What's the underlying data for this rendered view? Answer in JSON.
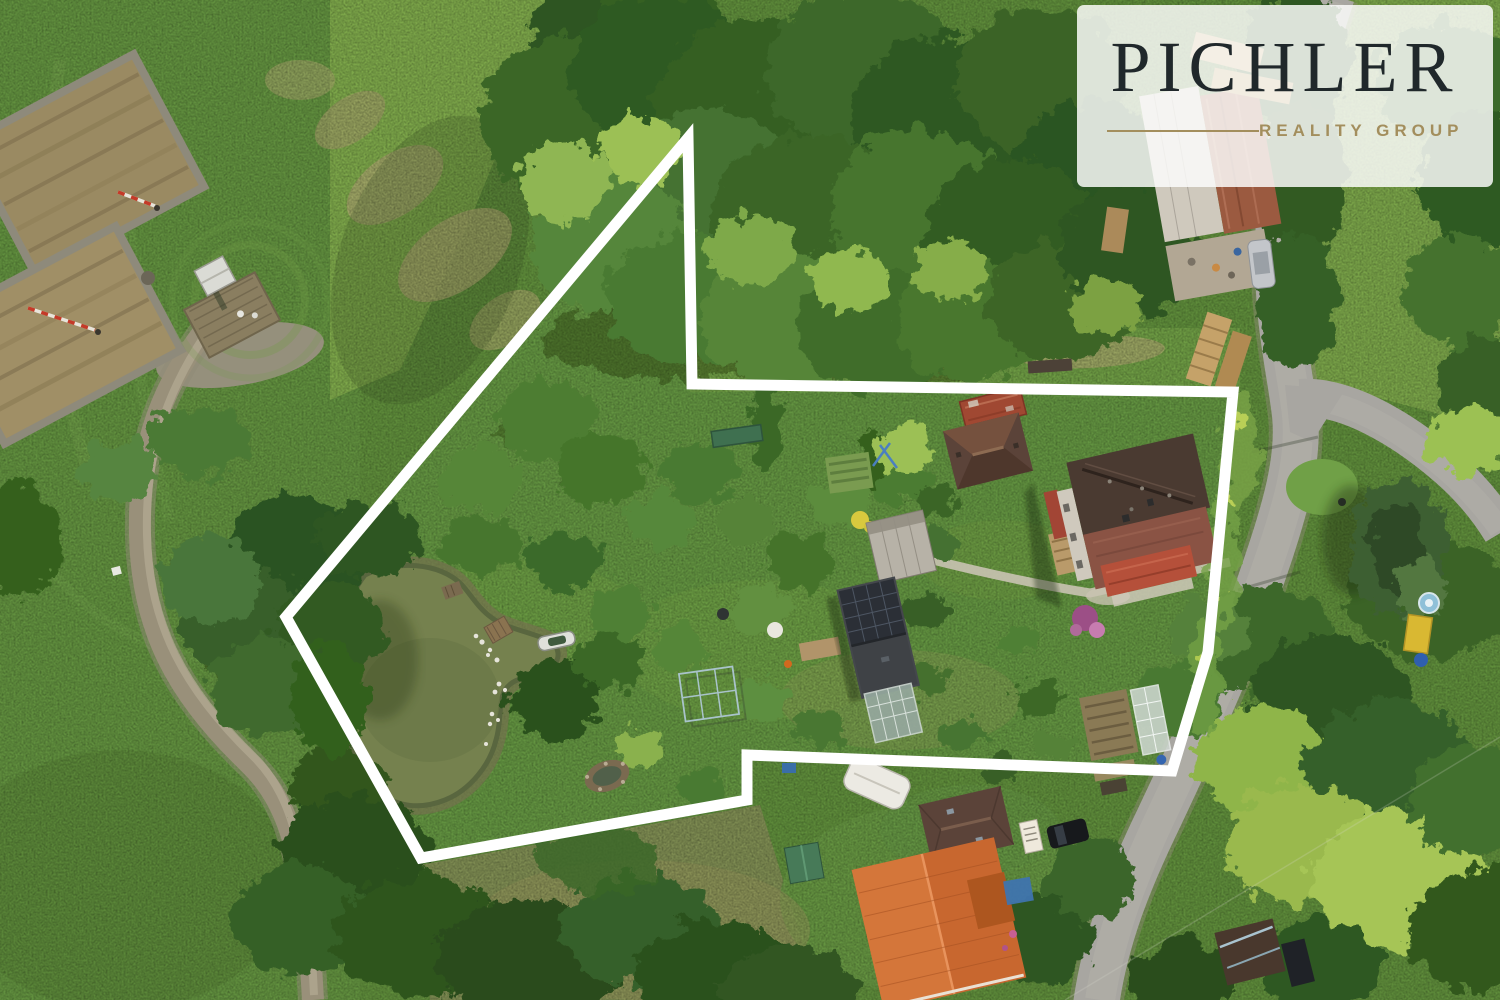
{
  "image_type": "aerial-drone-photograph-with-property-outline",
  "logo": {
    "brand": "PICHLER",
    "tagline": "REALITY GROUP",
    "brand_color": "#20282b",
    "accent_color": "#a38e5d",
    "badge_background": "rgba(253,253,251,0.84)"
  },
  "boundary": {
    "color": "#ffffff",
    "stroke_width": 11,
    "shape": "closed-polygon",
    "points": "688,138 286,617 421,858 747,800 747,755 1172,771 1208,652 1233,392 692,384"
  },
  "scene": {
    "canvas": {
      "width": 1500,
      "height": 1000
    },
    "palette": {
      "grass_base": "#5f8d3b",
      "grass_pasture": "#62913f",
      "grass_field_light": "#7da74a",
      "grass_lawn": "#639441",
      "grass_dry": "#7e8c52",
      "forest_dark": "#2e5520",
      "forest_mid": "#3c6a2b",
      "forest_light": "#8fb652",
      "pond_water": "#75814e",
      "pond_bank": "#6e6a4c",
      "road_asphalt": "#a8a6a1",
      "path_dirt": "#99907a",
      "walkway": "#c9c3b2",
      "roof_dark_brown": "#4a3a31",
      "roof_red": "#a04832",
      "roof_rust": "#9b5a40",
      "roof_orange": "#c8672f",
      "roof_brown_tile": "#5b4339",
      "solar_panel": "#2b2f36",
      "shed_green": "#477a58",
      "building_white": "#cfc9bd"
    },
    "objects": [
      {
        "id": "garden-plots",
        "label": "Tilled garden plots",
        "loc": [
          80,
          250
        ]
      },
      {
        "id": "white-shed",
        "label": "Small white shed",
        "loc": [
          215,
          276
        ]
      },
      {
        "id": "wooden-deck",
        "label": "Wooden deck platform",
        "loc": [
          232,
          315
        ]
      },
      {
        "id": "dirt-path",
        "label": "Gravel track",
        "loc": [
          220,
          650
        ]
      },
      {
        "id": "pond",
        "label": "Garden pond",
        "loc": [
          440,
          690
        ]
      },
      {
        "id": "rowboat",
        "label": "Rowboat at pond edge",
        "loc": [
          556,
          641
        ]
      },
      {
        "id": "wooden-raft",
        "label": "Wooden raft",
        "loc": [
          498,
          630
        ]
      },
      {
        "id": "pond-bench",
        "label": "Bench",
        "loc": [
          460,
          472
        ]
      },
      {
        "id": "orchard-lawn",
        "label": "Orchard lawn inside boundary",
        "loc": [
          700,
          600
        ]
      },
      {
        "id": "forest-band",
        "label": "Dense tree canopy",
        "loc": [
          820,
          180
        ]
      },
      {
        "id": "solar-outbuilding",
        "label": "Outbuilding with solar panels",
        "loc": [
          877,
          637
        ]
      },
      {
        "id": "gray-barn",
        "label": "Light-roofed barn",
        "loc": [
          900,
          546
        ]
      },
      {
        "id": "greenhouse",
        "label": "Greenhouse",
        "loc": [
          893,
          712
        ]
      },
      {
        "id": "red-roof-barn",
        "label": "Rusty red-roof shed",
        "loc": [
          993,
          408
        ]
      },
      {
        "id": "brown-roof-house",
        "label": "Brown hip-roof house",
        "loc": [
          988,
          451
        ]
      },
      {
        "id": "main-house",
        "label": "Main farmhouse",
        "loc": [
          1135,
          525
        ]
      },
      {
        "id": "farm-building-north",
        "label": "Farm building with rusted roof",
        "loc": [
          1205,
          165
        ]
      },
      {
        "id": "woodpile",
        "label": "Stacked lumber",
        "loc": [
          1215,
          350
        ]
      },
      {
        "id": "main-road",
        "label": "Asphalt road",
        "loc": [
          1280,
          500
        ]
      },
      {
        "id": "road-branch",
        "label": "Road branch to east",
        "loc": [
          1400,
          470
        ]
      },
      {
        "id": "junction-spruce",
        "label": "Spruce tree at junction",
        "loc": [
          1398,
          548
        ]
      },
      {
        "id": "caravan",
        "label": "White caravan",
        "loc": [
          876,
          783
        ]
      },
      {
        "id": "green-shed",
        "label": "Green garden shed",
        "loc": [
          804,
          862
        ]
      },
      {
        "id": "neighbor-house-brown",
        "label": "Neighbour house, brown tiles",
        "loc": [
          965,
          824
        ]
      },
      {
        "id": "neighbor-house-orange",
        "label": "Neighbour house, new orange roof",
        "loc": [
          938,
          924
        ]
      },
      {
        "id": "black-car",
        "label": "Parked black car",
        "loc": [
          1068,
          834
        ]
      },
      {
        "id": "silver-car",
        "label": "Parked silver car",
        "loc": [
          1261,
          264
        ]
      },
      {
        "id": "vegetable-beds",
        "label": "Vegetable beds and cold frame",
        "loc": [
          1125,
          730
        ]
      },
      {
        "id": "southeast-shed",
        "label": "Shed by the road",
        "loc": [
          1250,
          952
        ]
      },
      {
        "id": "yellow-container",
        "label": "Yellow container and pool",
        "loc": [
          1420,
          630
        ]
      },
      {
        "id": "survey-rods",
        "label": "Red-white survey rods",
        "loc": [
          130,
          200
        ]
      }
    ]
  }
}
